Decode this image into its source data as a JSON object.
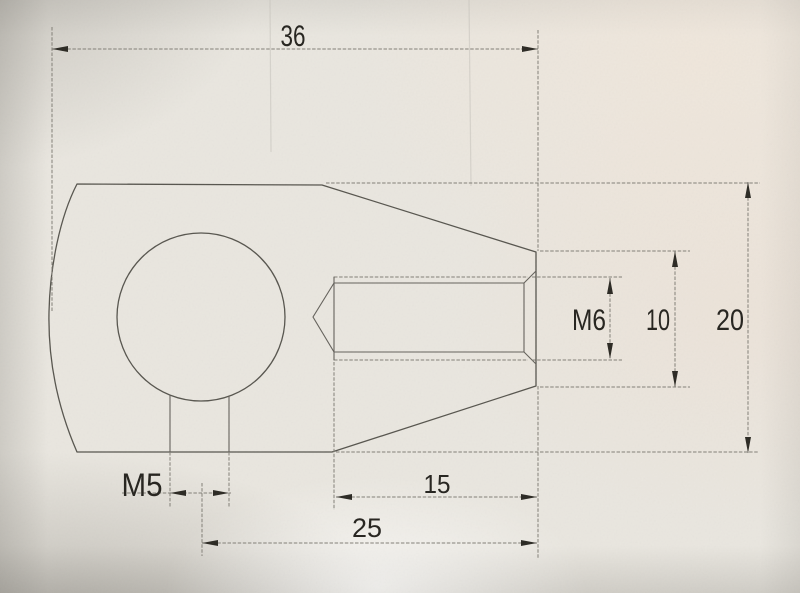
{
  "drawing": {
    "labels": {
      "overall_length": "36",
      "body_height": "20",
      "shank_diameter": "10",
      "thread_spec": "M6",
      "bottom_thread_spec": "M5",
      "thread_length": "15",
      "hole_to_end": "25"
    }
  }
}
